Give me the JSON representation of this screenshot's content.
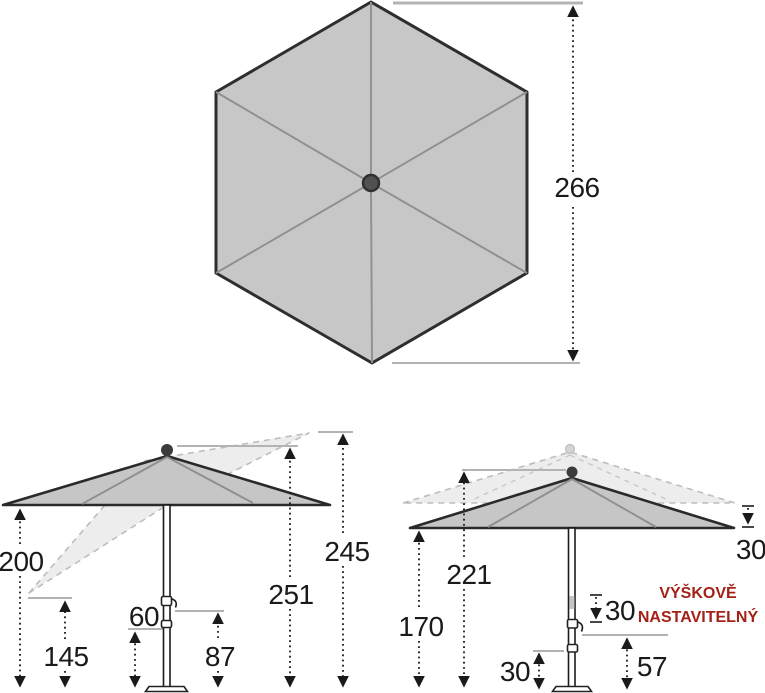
{
  "colors": {
    "canopy_gray": "#c6c6c6",
    "outline_dark": "#2a2a2a",
    "ghost_gray": "#bdbdbd",
    "reference_gray": "#b3b3b3",
    "dimension_black": "#1a1a1a",
    "note_red": "#a32117"
  },
  "top_view": {
    "width": "266"
  },
  "tilt_view": {
    "edge_height": "200",
    "tilted_edge_low": "145",
    "lower_joint": "60",
    "upper_joint": "87",
    "total_height": "251",
    "tilted_tip_high": "245"
  },
  "height_view": {
    "hub_height": "221",
    "edge_height": "170",
    "edge_drop": "30",
    "slider_travel": "30",
    "collar_height": "30",
    "crank_height": "57",
    "note_line1": "VÝŠKOVĚ",
    "note_line2": "NASTAVITELNÝ"
  }
}
